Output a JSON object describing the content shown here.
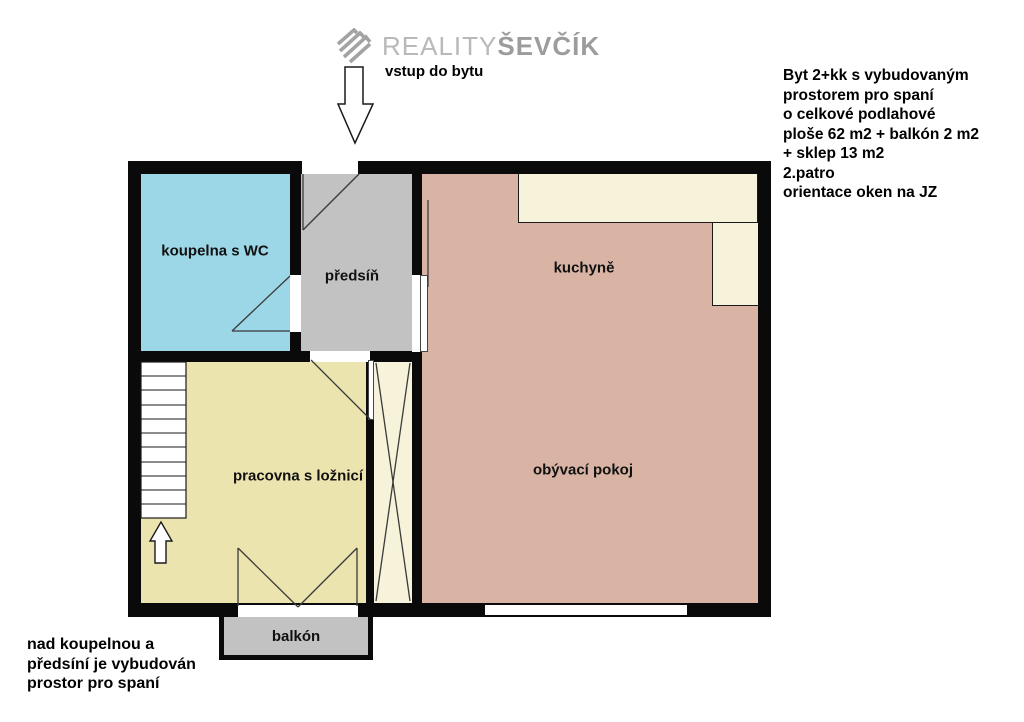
{
  "logo": {
    "brand_light": "REALITY",
    "brand_bold": "ŠEVČÍK"
  },
  "entrance": {
    "label": "vstup do bytu"
  },
  "info": {
    "lines": [
      "Byt 2+kk s vybudovaným",
      "prostorem pro spaní",
      "o celkové podlahové",
      "ploše 62 m2 + balkón 2 m2",
      "+ sklep 13 m2",
      "2.patro",
      "orientace oken na JZ"
    ]
  },
  "rooms": {
    "bathroom": "koupelna s WC",
    "hall": "předsíň",
    "kitchen": "kuchyně",
    "study": "pracovna s ložnicí",
    "living": "obývací pokoj",
    "balcony": "balkón"
  },
  "note": {
    "lines": [
      "nad koupelnou a",
      "předsíní je vybudován",
      "prostor pro spaní"
    ]
  },
  "colors": {
    "wall": "#0a0a0a",
    "bathroom": "#9bd7e6",
    "hall": "#c2c2c2",
    "kitchen_living": "#d9b4a4",
    "study": "#ece4ae",
    "wardrobe": "#f7f2da",
    "counter": "#f7f2da",
    "balcony": "#c2c2c2"
  }
}
